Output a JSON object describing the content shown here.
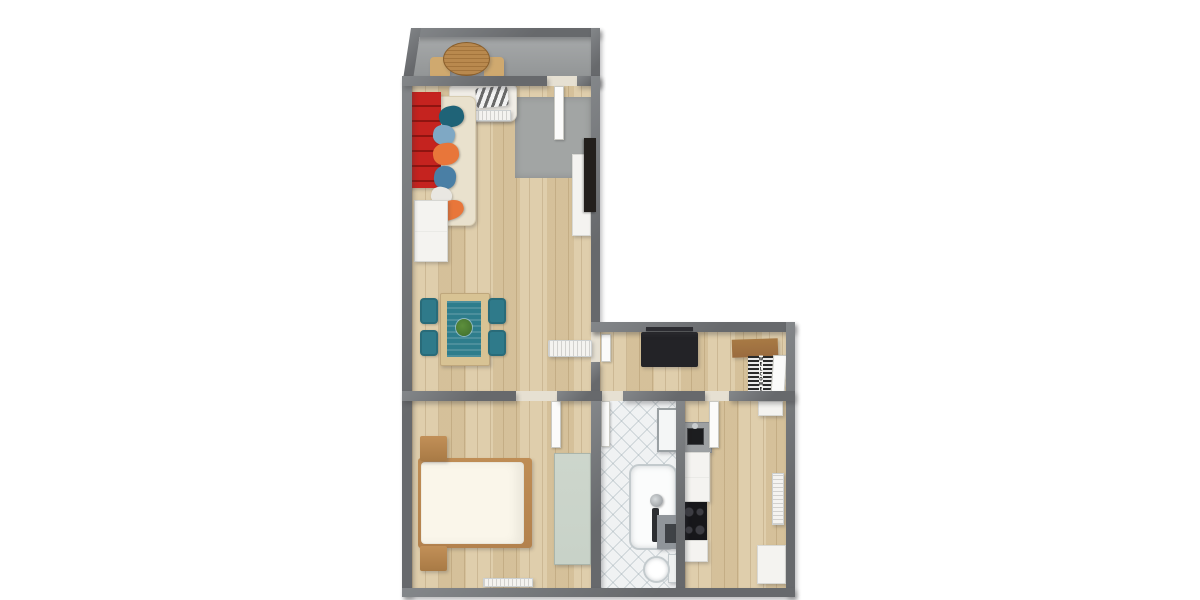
{
  "entrance_mat": {
    "text": "WELCOME"
  },
  "palette": {
    "background": "#ffffff",
    "wall": "#67696c",
    "wall_light": "#84878a",
    "wood": "#dbc7a0",
    "concrete": "#9c9fa0",
    "tile": "#f0f2f3",
    "rug": "#a2a5a4",
    "sofa_red": "#c5231f",
    "sofa_beige": "#e9e1cd",
    "sofa_white": "#f0ede6",
    "pillow_teal": "#1f6377",
    "pillow_lightblue": "#7fa8c4",
    "pillow_orange": "#e8763a",
    "pillow_blue": "#4a7fa5",
    "pillow_white": "#e9e7e2",
    "chair_teal": "#2f7a8a",
    "table_wood": "#d8c394",
    "runner_teal": "#2e7d8c",
    "plant_green": "#3f6d2c",
    "balcony_table": "#b9894e",
    "balcony_chair": "#cfa96f",
    "bed_frame": "#b3824e",
    "duvet": "#faf6ea",
    "wardrobe": "#c8d2c8",
    "black_furniture": "#232327",
    "shelf_brown": "#9a6b3f",
    "cooktop": "#17171a",
    "counter_gray": "#9da0a2",
    "white_furniture": "#f4f3f0",
    "door_white": "#fbfbfa",
    "tv_black": "#231f1c",
    "mat_dark": "#2a2a2a",
    "mat_light": "#eaeaea"
  },
  "semantics": {
    "rooms": [
      "balcony",
      "living-room",
      "hallway",
      "bedroom",
      "bathroom",
      "kitchen"
    ],
    "furniture": [
      "round-patio-table",
      "patio-chairs",
      "white-sofa",
      "striped-blanket",
      "beige-chaise-sofa",
      "red-shelf",
      "throw-pillows",
      "gray-rug",
      "white-dresser",
      "tv",
      "tv-bench",
      "dining-table",
      "table-runner",
      "plant-centerpiece",
      "dining-chairs",
      "radiators",
      "coat-rack",
      "black-sideboard",
      "wall-shelf",
      "welcome-mat",
      "double-bed",
      "nightstands",
      "wardrobe",
      "bathtub",
      "shower-column",
      "bath-caddy",
      "toilet",
      "washing-machine",
      "sink-counter",
      "kitchen-counter",
      "cooktop",
      "kitchen-cabinets",
      "door-leaves"
    ]
  }
}
